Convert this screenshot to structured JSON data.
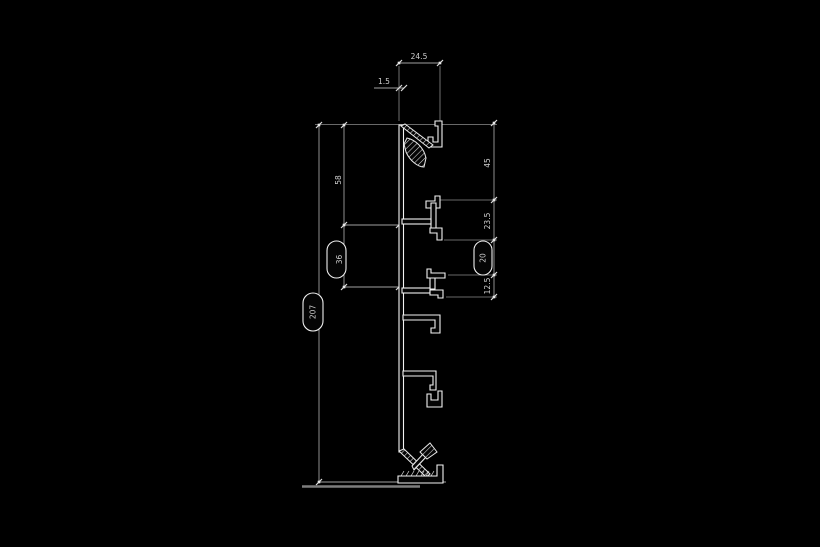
{
  "drawing": {
    "type": "profile-cross-section-technical-drawing",
    "background_color": "#000000",
    "profile_line_color": "#f2f2f2",
    "dimension_line_color": "#9f9f9f",
    "text_color": "#cfcfcf",
    "dims": {
      "top_width": "24.5",
      "top_small": "1.5",
      "left_upper": "58",
      "left_lower_balloon": "36",
      "overall_height_balloon": "207",
      "right_upper": "45",
      "right_mid": "23.5",
      "right_balloon": "20",
      "right_lower": "12.5"
    }
  }
}
